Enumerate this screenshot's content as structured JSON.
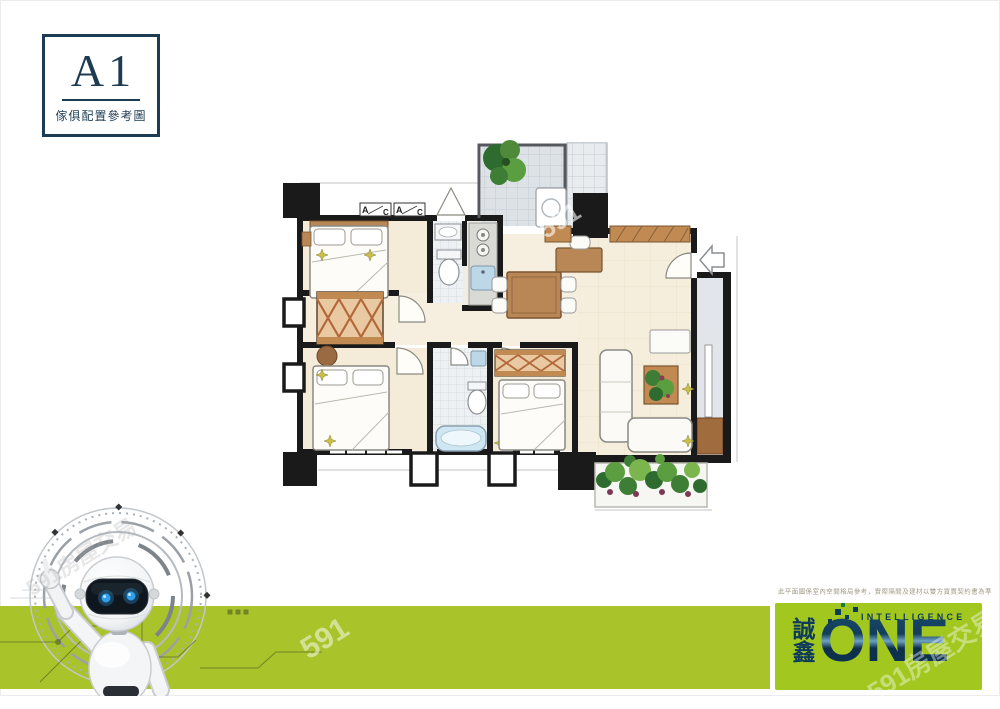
{
  "unit_card": {
    "title": "A1",
    "caption": "傢俱配置參考圖"
  },
  "closet_labels": {
    "left": "A",
    "right": "C"
  },
  "disclaimer": "此平面圖係室內空間格局參考，實際隔間及建材以雙方買賣契約書為準",
  "logo": {
    "company_vertical": [
      "誠",
      "鑫"
    ],
    "brand": "ONE",
    "tagline": "INTELLIGENCE"
  },
  "watermarks": {
    "site": "591房屋交易",
    "short": "591"
  },
  "colors": {
    "banner_green": "#a9c32b",
    "logo_green": "#a2c81f",
    "navy": "#1d3b52",
    "logo_navy": "#0e3a5c",
    "wall_black": "#1a1a1a",
    "floor_cream": "#f4ecd9",
    "wood": "#b98756",
    "tile_gray": "#dde2e7",
    "tub_blue": "#cfe7f2",
    "plant_green": "#4e8a3a",
    "robot_eye_blue": "#2f9fe8"
  }
}
